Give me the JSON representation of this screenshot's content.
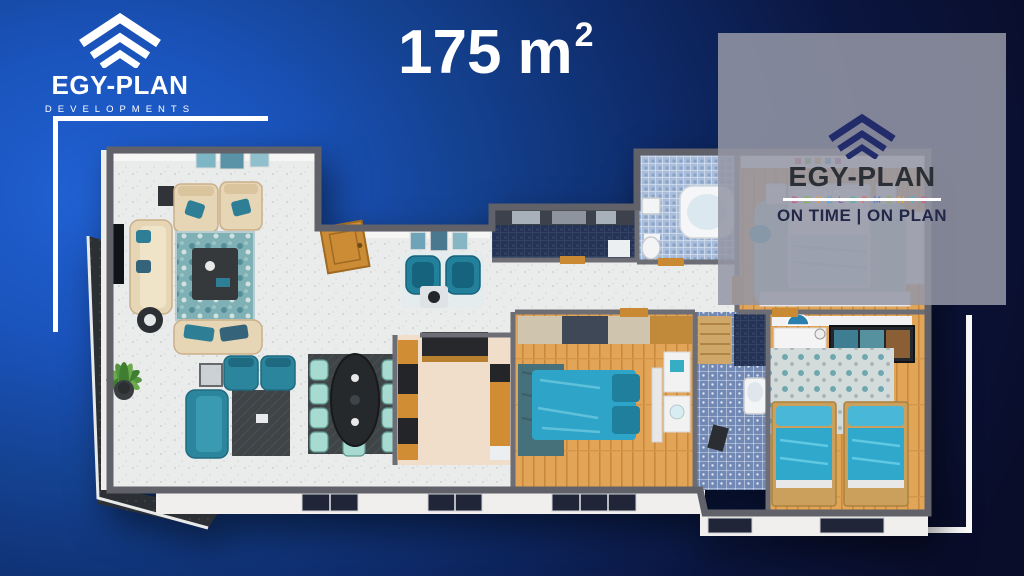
{
  "header": {
    "area_title": {
      "value": "175",
      "unit": "m",
      "exponent": "2"
    }
  },
  "brand_logo": {
    "name": "EGY-PLAN",
    "tagline": "DEVELOPMENTS"
  },
  "watermark_logo": {
    "name": "EGY-PLAN",
    "tagline": "DEVELOPMENTS",
    "slogan": "ON TIME | ON PLAN"
  },
  "colors": {
    "background_blue": "#1a53bb",
    "background_navy": "#090d2a",
    "accent_teal": "#2b869d",
    "bed_blue": "#2fa8cc",
    "wood": "#e2a557",
    "watermark_panel": "#9496a5",
    "wall_gray": "#606169",
    "white": "#ffffff"
  }
}
